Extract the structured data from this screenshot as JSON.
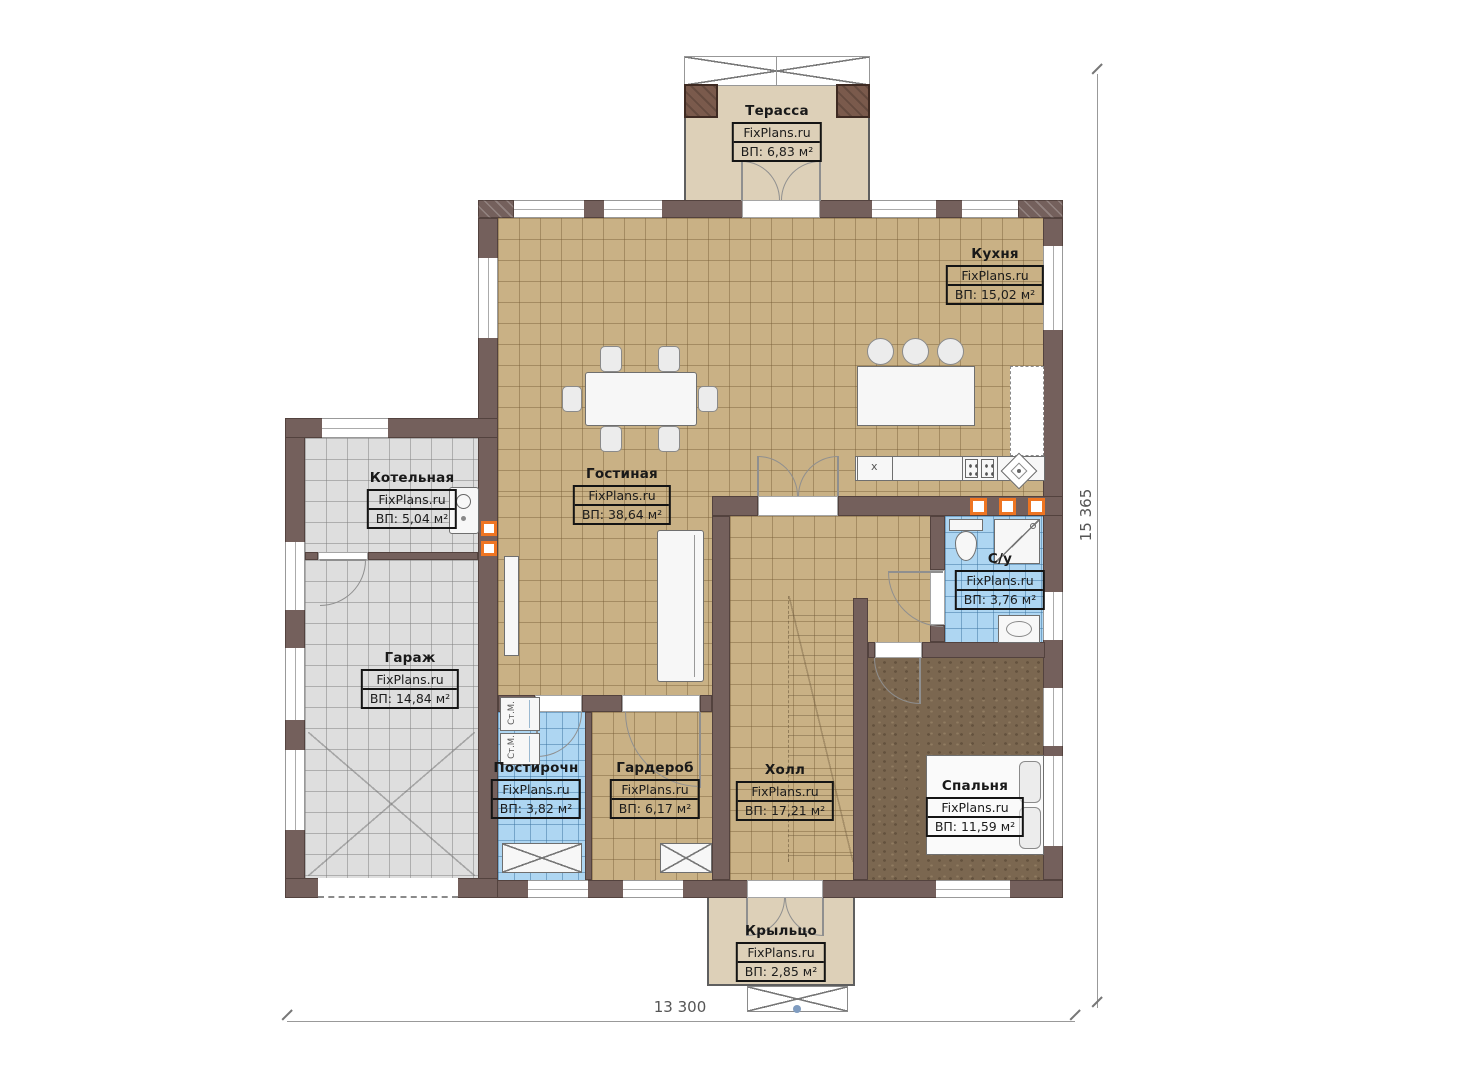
{
  "watermark": "FixPlans.ru",
  "rooms": {
    "terrace": {
      "name": "Терасса",
      "area": "ВП: 6,83 м²"
    },
    "kitchen": {
      "name": "Кухня",
      "area": "ВП: 15,02 м²"
    },
    "living_room": {
      "name": "Гостиная",
      "area": "ВП: 38,64 м²"
    },
    "boiler_room": {
      "name": "Котельная",
      "area": "ВП: 5,04 м²"
    },
    "garage": {
      "name": "Гараж",
      "area": "ВП: 14,84 м²"
    },
    "bathroom": {
      "name": "С/у",
      "area": "ВП: 3,76 м²"
    },
    "laundry": {
      "name": "Постирочн",
      "area": "ВП: 3,82 м²"
    },
    "wardrobe": {
      "name": "Гардероб",
      "area": "ВП: 6,17 м²"
    },
    "hall": {
      "name": "Холл",
      "area": "ВП: 17,21 м²"
    },
    "bedroom": {
      "name": "Спальня",
      "area": "ВП: 11,59 м²"
    },
    "porch": {
      "name": "Крыльцо",
      "area": "ВП: 2,85 м²"
    }
  },
  "dimensions": {
    "bottom_width": "13 300",
    "right_height": "15 365"
  },
  "labels": {
    "washer": "Ст.М.",
    "sink_mark": "x"
  },
  "colors": {
    "wall": "#74605c",
    "tile_tan": "#c9b185",
    "tile_gray": "#dedede",
    "tile_blue": "#aed6f2",
    "carpet": "#7b6750",
    "terrace_floor": "#ddd0b8",
    "accent_orange": "#ee7522"
  }
}
